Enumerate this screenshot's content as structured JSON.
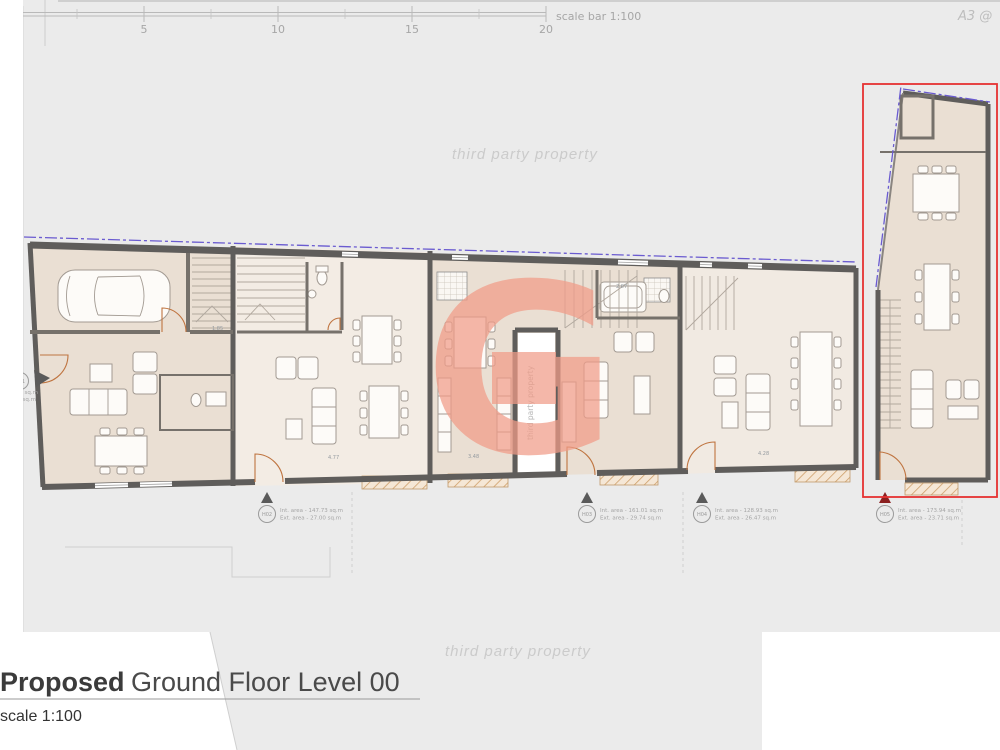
{
  "sheet": {
    "a3_label": "A3 @"
  },
  "scale_bar": {
    "ticks": [
      "0",
      "5",
      "10",
      "15",
      "20"
    ],
    "label": "scale bar 1:100"
  },
  "watermarks": {
    "top": "third party property",
    "bottom": "third party property",
    "courtyard": "third party property"
  },
  "logo": {
    "letter": "G",
    "color": "#f19c88"
  },
  "units": [
    {
      "id": "H01",
      "int_area": "Int. area - 107.59 sq.m",
      "ext_area": "Ext. area - 10.35 sq.m"
    },
    {
      "id": "H02",
      "int_area": "Int. area - 147.73 sq.m",
      "ext_area": "Ext. area - 27.00 sq.m"
    },
    {
      "id": "H03",
      "int_area": "Int. area - 161.01 sq.m",
      "ext_area": "Ext. area - 29.74 sq.m"
    },
    {
      "id": "H04",
      "int_area": "Int. area - 128.93 sq.m",
      "ext_area": "Ext. area - 26.47 sq.m"
    },
    {
      "id": "H05",
      "int_area": "Int. area - 173.94 sq.m",
      "ext_area": "Ext. area - 23.71 sq.m"
    }
  ],
  "dims": {
    "garage_stairs": "1.85",
    "h02_width": "4.77",
    "h03_width": "3.48",
    "h03_bath": "2.87",
    "h04_width": "4.28"
  },
  "title": {
    "bold": "Proposed",
    "regular": "Ground Floor Level 00",
    "scale_note": "scale 1:100"
  },
  "colors": {
    "highlight_red": "#e63232",
    "boundary_purple": "#6a5bd0",
    "floor_tan": "#eadfd3",
    "wall_gray": "#5f5d5b",
    "sheet_gray": "#ebebeb"
  }
}
